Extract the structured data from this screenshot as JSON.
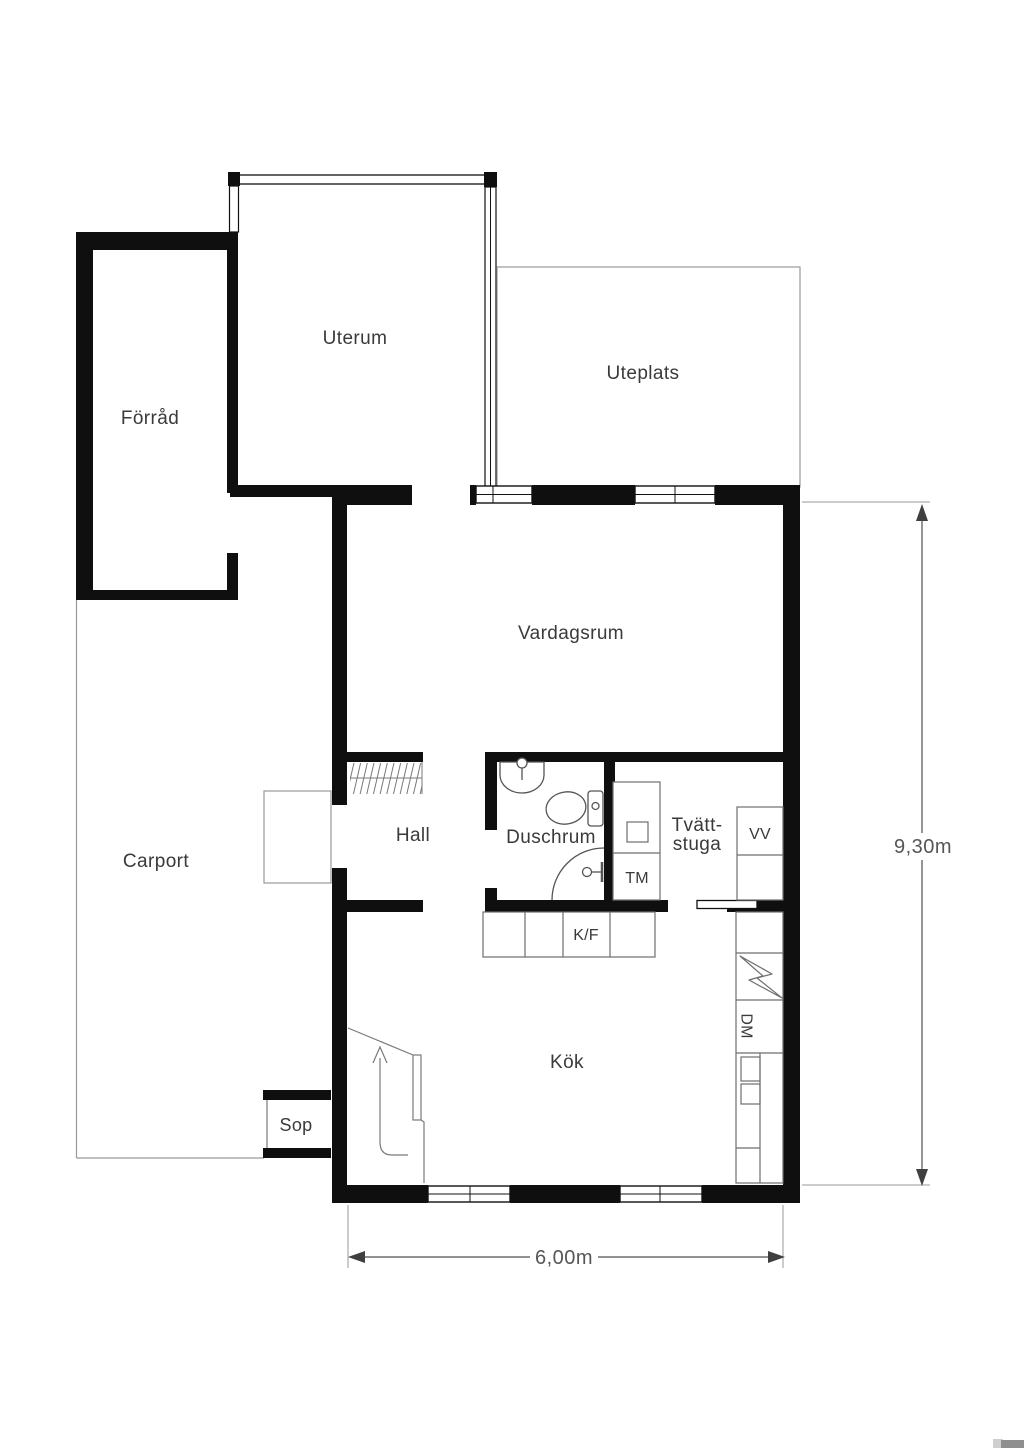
{
  "plan": {
    "rooms": {
      "forrad": "Förråd",
      "uterum": "Uterum",
      "uteplats": "Uteplats",
      "carport": "Carport",
      "vardagsrum": "Vardagsrum",
      "hall": "Hall",
      "duschrum": "Duschrum",
      "tvattstuga_line1": "Tvätt-",
      "tvattstuga_line2": "stuga",
      "kok": "Kök",
      "sop": "Sop"
    },
    "appliances": {
      "tm": "TM",
      "vv": "VV",
      "dm": "DM",
      "kf": "K/F"
    },
    "dimensions": {
      "height": "9,30m",
      "width": "6,00m"
    },
    "colors": {
      "wall": "#0f0f0f",
      "thin_outline": "#9a9a9a",
      "fixture": "#555555",
      "counter": "#6e6e6e",
      "text": "#3a3a3a",
      "dimension": "#565656",
      "background": "#ffffff"
    }
  }
}
